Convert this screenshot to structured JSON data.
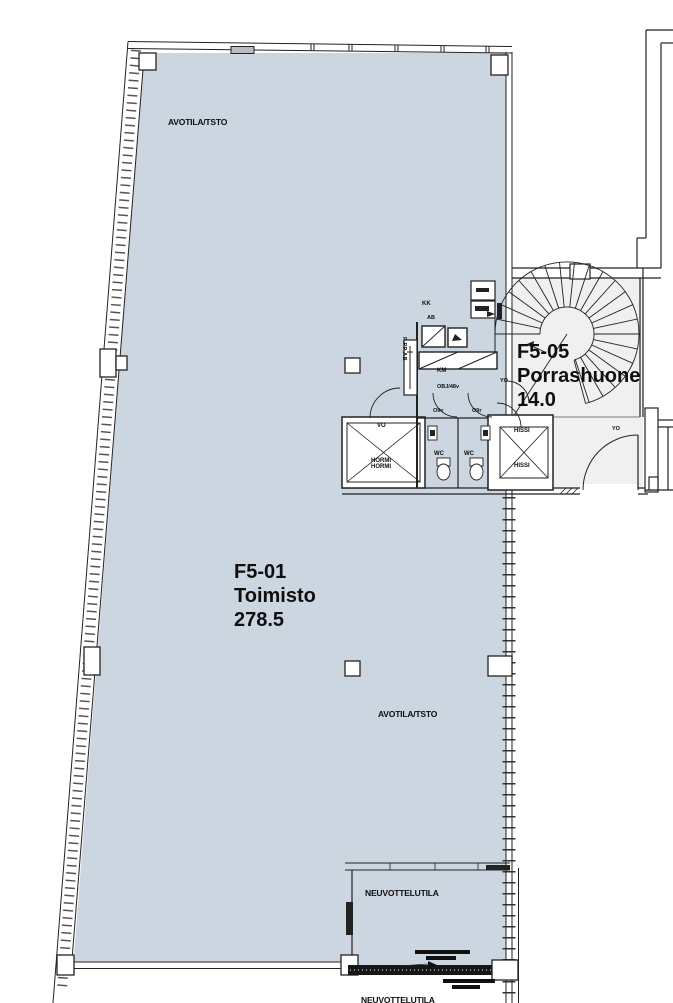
{
  "rooms": {
    "toimisto": {
      "id": "F5-01",
      "name": "Toimisto",
      "area": "278.5"
    },
    "porrashuone": {
      "id": "F5-05",
      "name": "Porrashuone",
      "area": "14.0"
    },
    "neuvottelutila": {
      "name": "NEUVOTTELUTILA"
    },
    "neuvottelutila_below": {
      "name": "NEUVOTTELUTILA"
    },
    "avotila_top": {
      "name": "AVOTILA/TSTO"
    },
    "avotila_mid": {
      "name": "AVOTILA/TSTO"
    }
  },
  "labels": {
    "hormi_1": "HORMI",
    "hormi_2": "HORMI",
    "vo": "VO",
    "hissi_1": "HISSI",
    "hissi_2": "HISSI",
    "wc_1": "WC",
    "wc_2": "WC",
    "km": "KM",
    "kk": "KK",
    "obj": "OBJ/48v",
    "door_left": "O9v",
    "door_right": "O9r",
    "yo_1": "YO",
    "yo_2": "YO",
    "ab": "AB",
    "ppp": "P.PP.AB"
  },
  "colors": {
    "zone_fill": "#ccd6e1",
    "stair_fill": "#f0f0f0",
    "wall": "#1c1c1c",
    "window_gray": "#b8bcc0"
  }
}
